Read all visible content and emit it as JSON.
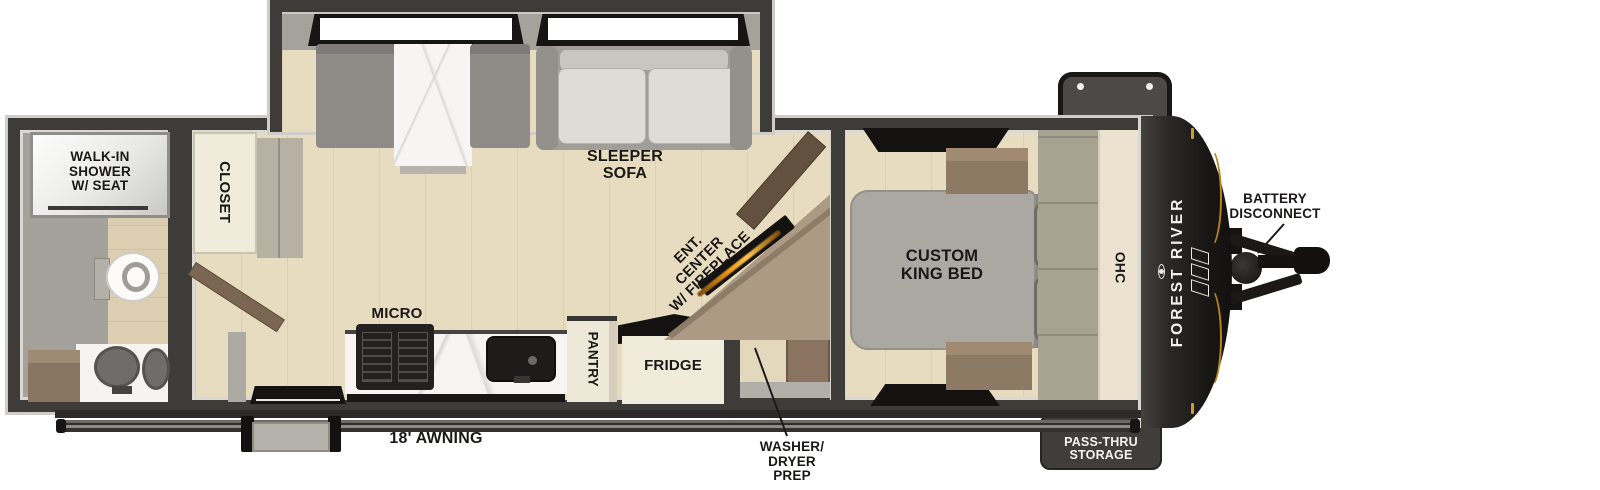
{
  "labels": {
    "shower": [
      "WALK-IN",
      "SHOWER",
      "W/ SEAT"
    ],
    "closet": "CLOSET",
    "sleeper": [
      "SLEEPER",
      "SOFA"
    ],
    "ent": [
      "ENT.",
      "CENTER",
      "W/ FIREPLACE"
    ],
    "micro": "MICRO",
    "pantry": "PANTRY",
    "fridge": "FRIDGE",
    "washer": [
      "WASHER/",
      "DRYER",
      "PREP"
    ],
    "bed": [
      "CUSTOM",
      "KING BED"
    ],
    "ohc": "OHC",
    "awning": "18' AWNING",
    "battery": [
      "BATTERY",
      "DISCONNECT"
    ],
    "storage": [
      "LARGE",
      "PASS-THRU",
      "STORAGE"
    ],
    "brand": "FOREST RIVER"
  },
  "colors": {
    "wall": "#3e3c39",
    "floor_tan": "#e8dcc0",
    "accent_amber": "#c8881e",
    "fireplace_glow": "#f09c1a",
    "label_ink": "#191817"
  }
}
